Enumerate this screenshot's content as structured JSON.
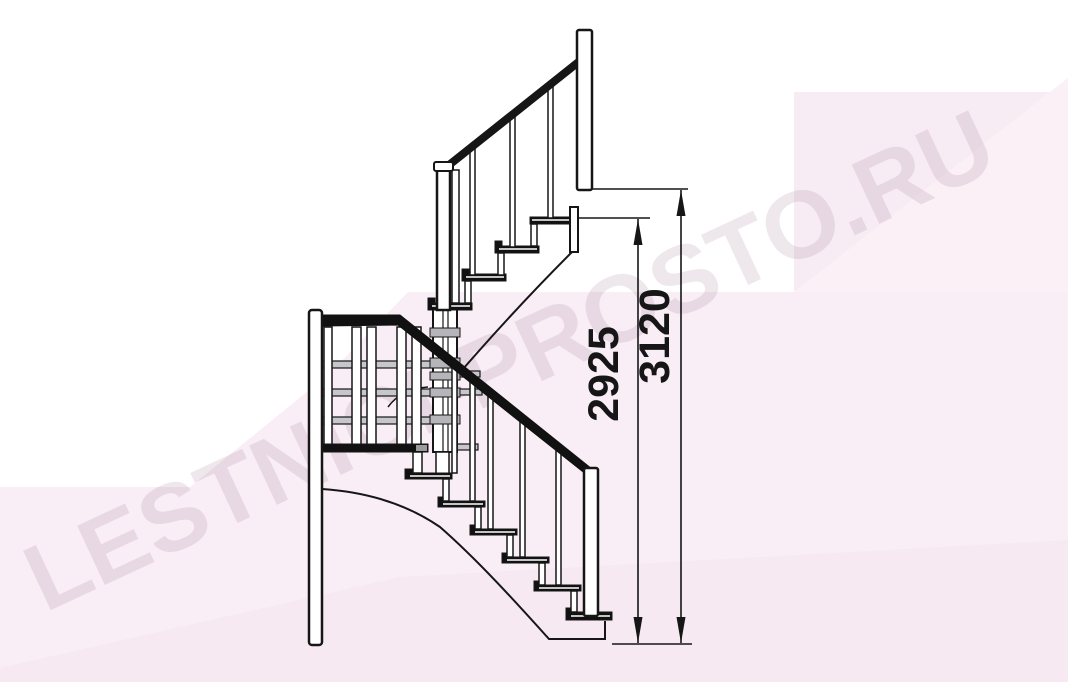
{
  "drawing": {
    "kind": "staircase-side-elevation",
    "dimension_total_height": "3120",
    "dimension_to_top_step": "2925"
  },
  "watermark": {
    "text": "LESTNICI-PROSTO.RU"
  },
  "colors": {
    "line": "#161616",
    "background": "#ffffff",
    "tint_pink": "#f8ecf4",
    "tint_pink_light": "#fbf2f8",
    "tint_pink_deep": "#f6e9f2",
    "tread_fill": "#111111",
    "hardware_gray": "#b5b5ba",
    "watermark_color": "rgba(104,44,82,0.11)"
  }
}
